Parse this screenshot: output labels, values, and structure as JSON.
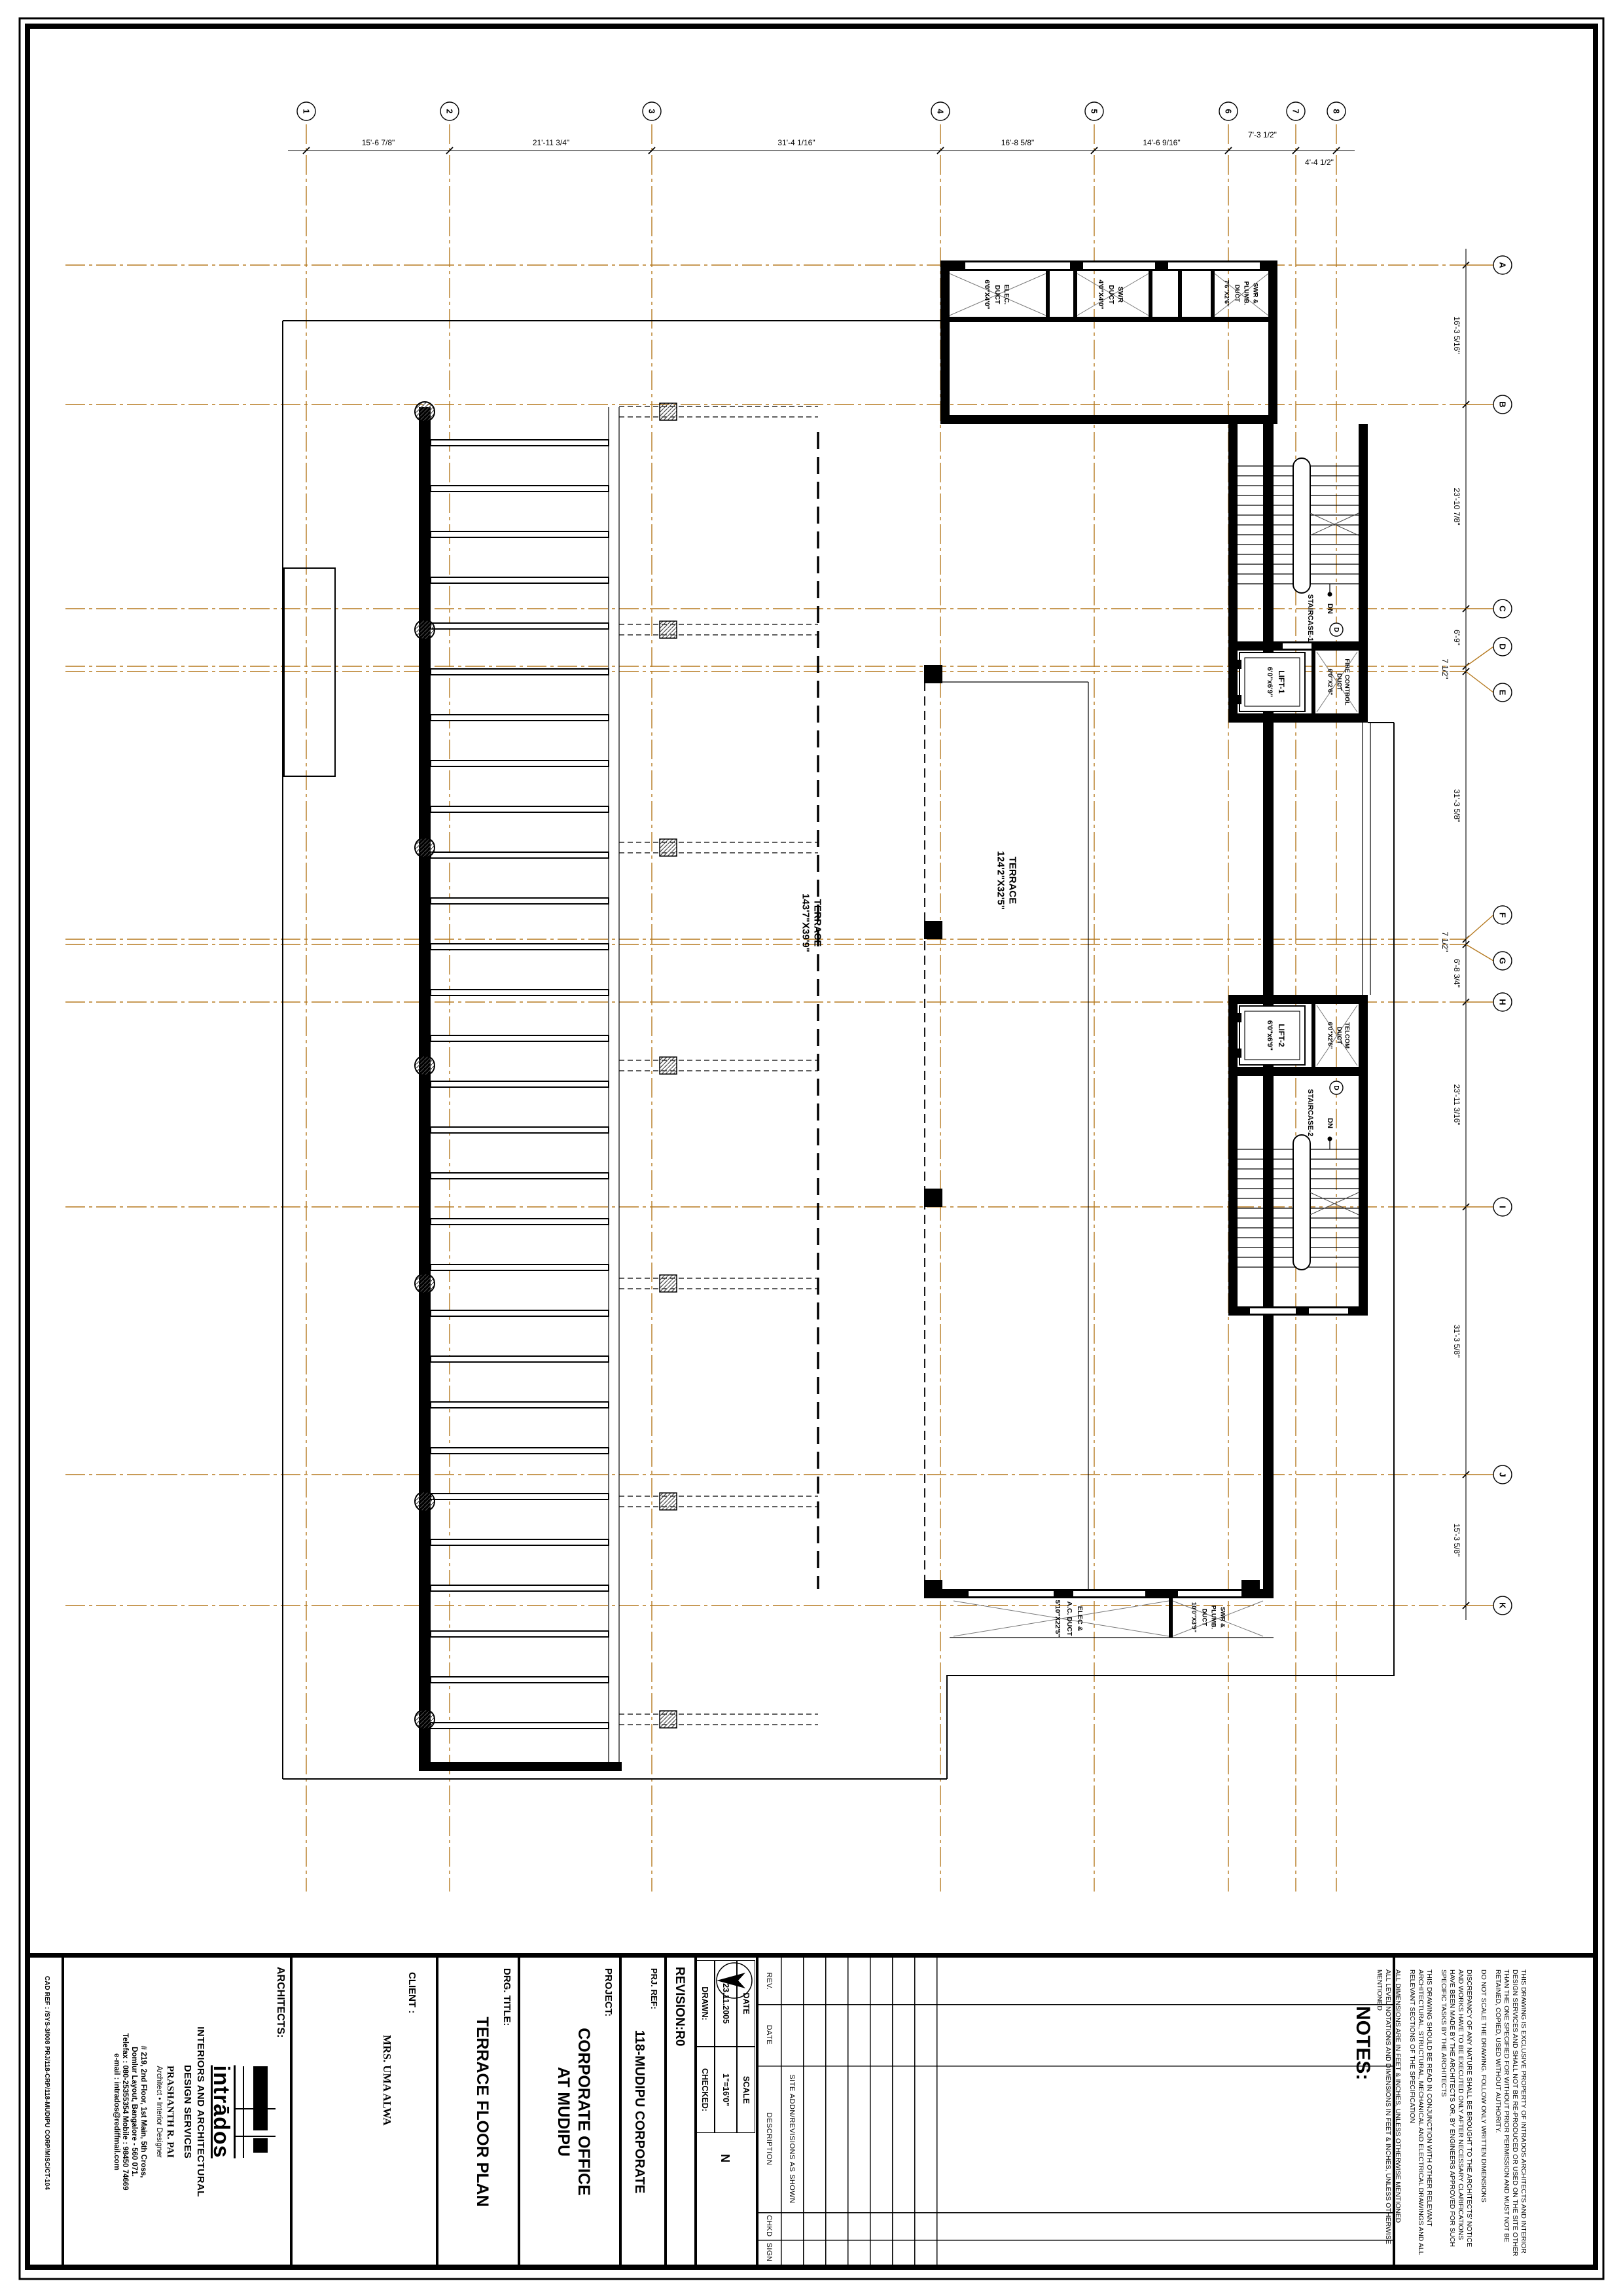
{
  "colors": {
    "grid": "#b5791f",
    "wall": "#000000",
    "hatch_line": "#666666"
  },
  "grid": {
    "cols": [
      "1",
      "2",
      "3",
      "4",
      "5",
      "6",
      "7",
      "8"
    ],
    "col_dims": [
      "15'-6 7/8\"",
      "21'-11 3/4\"",
      "31'-4 1/16\"",
      "16'-8 5/8\"",
      "14'-6 9/16\"",
      "7'-3 1/2\"",
      "4'-4 1/2\""
    ],
    "rows": [
      "A",
      "B",
      "C",
      "D",
      "E",
      "F",
      "G",
      "H",
      "I",
      "J",
      "K"
    ],
    "row_dims": [
      "16'-3 5/16\"",
      "23'-10 7/8\"",
      "6'-9\"",
      "7 1/2\"",
      "31'-3 5/8\"",
      "7 1/2\"",
      "6'-8 3/4\"",
      "23'-11 3/16\"",
      "31'-3 5/8\"",
      "15'-3 5/8\""
    ]
  },
  "plan": {
    "terrace_main": {
      "name": "TERRACE",
      "size": "143'7\"X39'9\""
    },
    "terrace_below": {
      "name": "TERRACE",
      "size": "124'2\"X32'5\""
    },
    "staircase1": "STAIRCASE-1",
    "staircase2": "STAIRCASE-2",
    "up": "UP",
    "dn": "DN",
    "door_tag": "D",
    "lift1": {
      "name": "LIFT-1",
      "size": "6'0\"x6'9\""
    },
    "lift2": {
      "name": "LIFT-2",
      "size": "6'0\"x6'9\""
    },
    "fire_duct": {
      "l1": "FIRE CONTROL",
      "l2": "DUCT",
      "size": "6'0\"X2'6\""
    },
    "telcom_duct": {
      "l1": "TELCOM",
      "l2": "DUCT",
      "size": "6'0\"X2'6\""
    },
    "elec_duct": {
      "l1": "ELEC.",
      "l2": "DUCT",
      "size": "6'0\"X4'0\""
    },
    "swr_duct": {
      "l1": "SWR",
      "l2": "DUCT",
      "size": "4'0\"X4'0\""
    },
    "swr_plumb": {
      "l1": "SWR &",
      "l2": "PLUMB.",
      "l3": "DUCT",
      "size": "7'6\"X2'6\""
    },
    "elec_ac": {
      "l1": "ELEC &",
      "l2": "A.C. DUCT",
      "size": "5'10\"X22'5\""
    },
    "swr_plumb2": {
      "l1": "SWR &",
      "l2": "PLUMB.",
      "l3": "DUCT",
      "size": "10'0\"X3'9\""
    }
  },
  "title": {
    "cad_ref": "CAD REF : /SYS-3/008 PRJ/118-CRP/118-MUDIPU CORP/MISC/CT-104",
    "architects": {
      "label": "ARCHITECTS:",
      "logo": "intrādos",
      "firm1": "INTERIORS AND ARCHITECTURAL",
      "firm2": "DESIGN SERVICES",
      "principal": "PRASHANTH R. PAI",
      "principal_title": "Architect • Interior Designer",
      "addr1": "# 219, 2nd Floor, 1st Main, 5th Cross,",
      "addr2": "Domlur Layout, Bangalore - 560 071.",
      "addr3": "Telefax : 080-25355354   Mobile : 98450 74669",
      "addr4": "e-mail : intrados@rediffmail.com"
    },
    "client_label": "CLIENT :",
    "client_name": "MRS. UMA ALWA",
    "drg_label": "DRG. TITLE:",
    "drg_title": "TERRACE FLOOR PLAN",
    "project_label": "PROJECT:",
    "project1": "CORPORATE OFFICE",
    "project2": "AT MUDIPU",
    "prj_ref_label": "PRJ. REF:",
    "prj_ref": "118-MUDIPU CORPORATE",
    "revision": "REVISION:R0",
    "date_label": "DATE",
    "date": "23.11.2005",
    "scale_label": "SCALE",
    "scale": "1\"=16'0\"",
    "drawn_label": "DRAWN:",
    "checked_label": "CHECKED:",
    "north": "N",
    "rev_table": {
      "h1": "REV.",
      "h2": "DATE",
      "h3": "DESCRIPTION",
      "h4": "CHKD",
      "h5": "SIGN",
      "entry": "SITE ADDN/REVISIONS AS SHOWN"
    }
  },
  "notes": {
    "heading": "NOTES:",
    "items": [
      "THIS DRAWING IS EXCLUSIVE PROPERTY OF INTRADOS ARCHITECTS AND INTERIOR DESIGN SERVICES AND SHALL NOT BE RE-PRODUCED OR USED ON THE SITE OTHER THAN THE ONE SPECIFIED FOR WITHOUT PRIOR PERMISSION AND MUST NOT BE RETAINED, COPIED, USED WITHOUT AUTHORITY.",
      "DO NOT SCALE THE DRAWING. FOLLOW ONLY WRITTEN DIMENSIONS",
      "DISCREPANCY OF ANY NATURE SHALL BE BROUGHT TO THE ARCHITECTS' NOTICE AND WORKS HAVE TO BE EXECUTED ONLY AFTER NECESSARY CLARIFICATIONS HAVE BEEN MADE BY THE ARCHITECTS OR, BY ENGINEERS APPROVED FOR SUCH SPECIFIC TASKS BY THE ARCHITECTS",
      "THIS DRAWING SHOULD BE READ IN CONJUNCTION WITH OTHER RELEVANT ARCHITECTURAL, STRUCTURAL, MECHANICAL AND ELECTRICAL DRAWINGS AND ALL RELEVANT SECTIONS OF THE SPECIFICATION",
      "ALL DIMENSIONS ARE IN FEET & INCHES, UNLESS OTHERWISE MENTIONED",
      "ALL LEVEL NOTATIONS AND DIMENSIONS IN FEET & INCHES, UNLESS OTHERWISE MENTIONED"
    ]
  }
}
